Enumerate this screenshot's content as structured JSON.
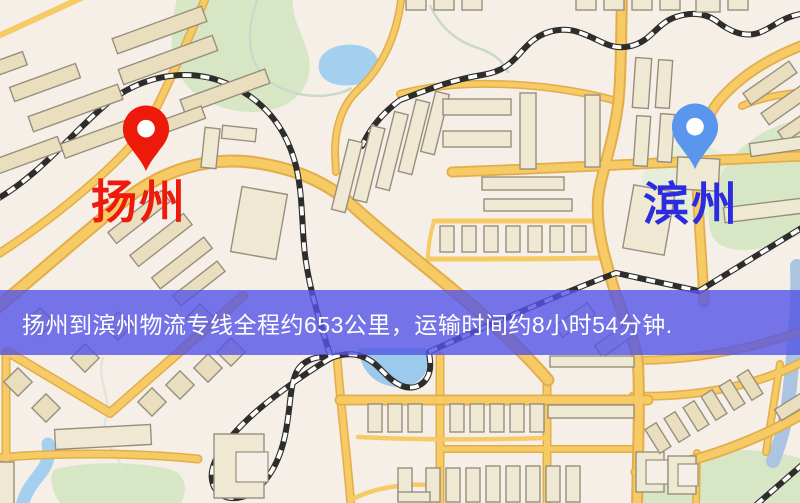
{
  "banner": {
    "text": "扬州到滨州物流专线全程约653公里，运输时间约8小时54分钟.",
    "background": "#5454e6",
    "text_color": "#ffffff"
  },
  "markers": {
    "origin": {
      "label": "扬州",
      "pin_color": "#ed1a0c",
      "label_color": "#ee1a0c"
    },
    "destination": {
      "label": "滨州",
      "pin_color": "#5b96ee",
      "label_color": "#2b2ce0"
    }
  },
  "css_vars": {
    "map-bg": "#f6efe8",
    "road": "#f6ca64",
    "road-casing": "#e3ad4a",
    "bld-fill": "#e9dfbf",
    "bld-fill-light": "#efe8d2",
    "bld-stroke": "#978f7d",
    "water": "#a3d0ef",
    "park": "#d7e7c5",
    "park-light": "#e4eed8",
    "rail-dark": "#2e2d2b",
    "rail-light": "#fcfcf9",
    "stream": "#cdd8cd",
    "banner-bg": "rgba(84,84,230,0.80)",
    "banner-text": "#ffffff"
  }
}
